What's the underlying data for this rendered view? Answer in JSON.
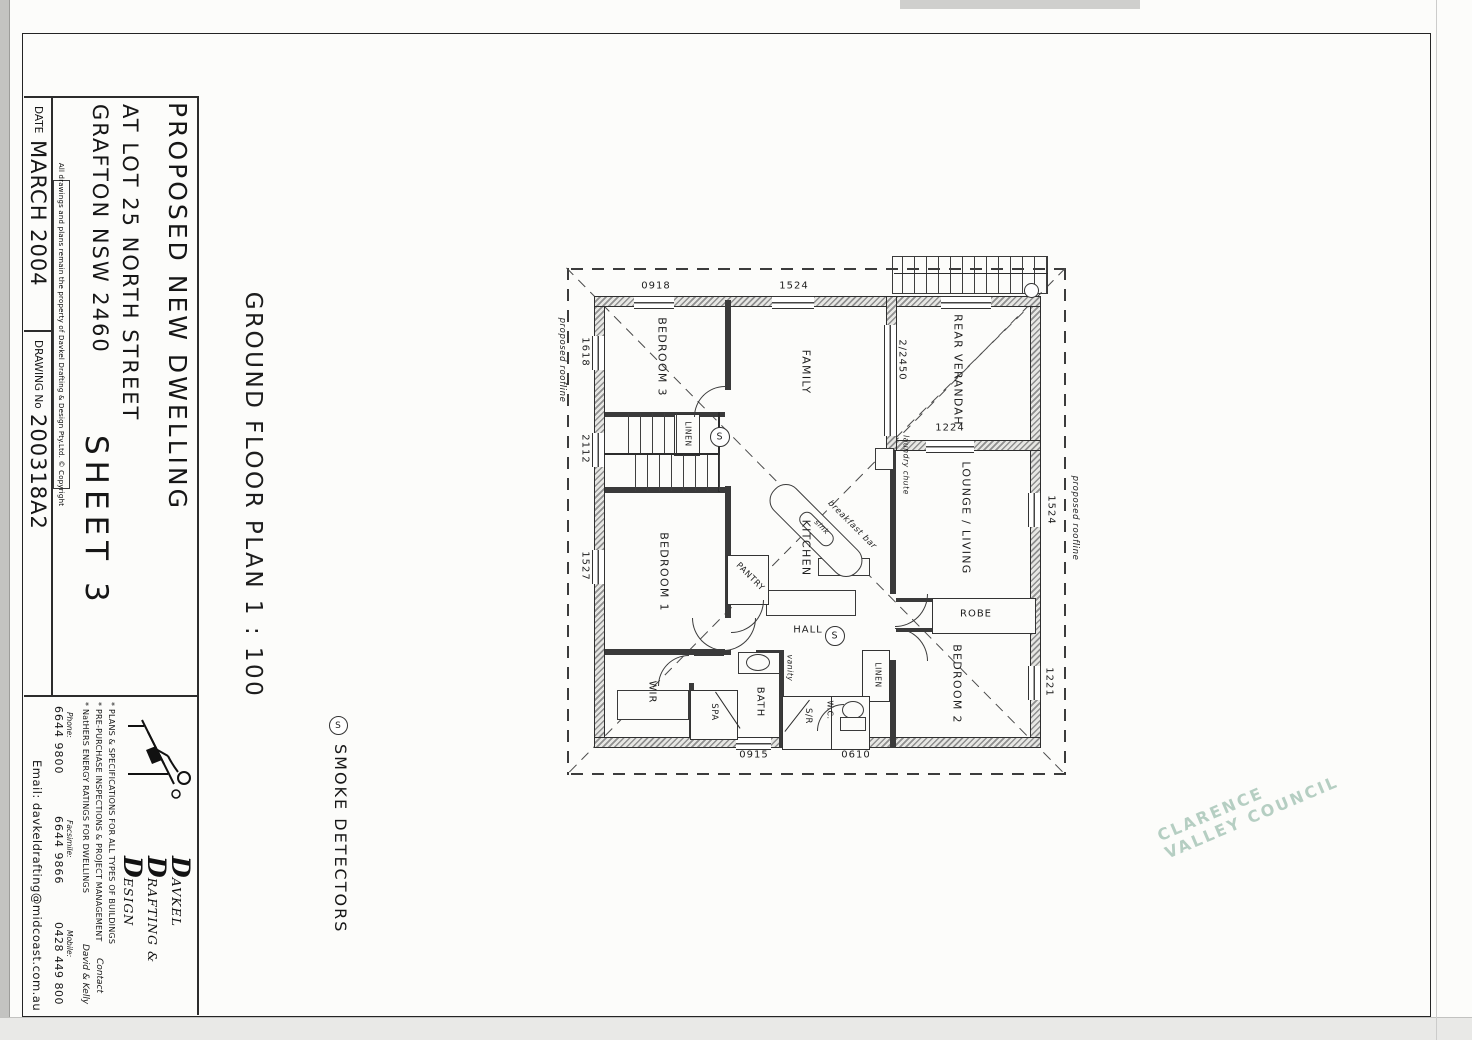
{
  "sheet": {
    "watermark": "CLARENCE VALLEY COUNCIL",
    "caption": "GROUND FLOOR PLAN  1 : 100",
    "legend_symbol": "S",
    "legend_label": "SMOKE DETECTORS"
  },
  "title_block": {
    "project_title": "PROPOSED NEW DWELLING",
    "address_line1": "AT LOT 25 NORTH STREET",
    "address_line2": "GRAFTON NSW 2460",
    "sheet_label": "SHEET 3",
    "date_label": "DATE",
    "date_value": "MARCH 2004",
    "drawing_no_label": "DRAWING No",
    "drawing_no_value": "200318A2",
    "copyright": "All drawings and plans remain the property of Davkel Drafting & Design Pty.Ltd. © Copyright"
  },
  "logo": {
    "initial": "D",
    "name_line1": "AVKEL",
    "name_line2": "RAFTING &",
    "name_line3": "ESIGN",
    "bullets": [
      "* PLANS & SPECIFICATIONS FOR ALL TYPES OF BUILDINGS",
      "* PRE-PURCHASE INSPECTIONS & PROJECT MANAGEMENT",
      "* NatHERS ENERGY RATINGS FOR DWELLINGS"
    ],
    "phone_label": "Phone:",
    "phone": "6644 9800",
    "fax_label": "Facsimile:",
    "fax": "6644 9866",
    "mobile_label": "Mobile:",
    "mobile": "0428 449 800",
    "contact_label": "Contact",
    "contact_names": "David & Kelly",
    "email": "Email: davkeldrafting@midcoast.com.au"
  },
  "plan": {
    "rooms": [
      "REAR VERANDAH",
      "LOUNGE / LIVING",
      "BEDROOM 2",
      "ROBE",
      "FAMILY",
      "BEDROOM 3",
      "BEDROOM 1",
      "KITCHEN",
      "HALL",
      "WIR",
      "BATH",
      "SPA",
      "S/R",
      "W.C.",
      "LINEN",
      "LINEN",
      "PANTRY"
    ],
    "dims": [
      "0918",
      "1524",
      "1524",
      "1221",
      "1618",
      "2112",
      "1527",
      "0915",
      "0610",
      "1224",
      "2/2450"
    ],
    "labels": [
      "sink",
      "breakfast bar",
      "laundry chute",
      "vanity",
      "proposed roofline",
      "proposed roofline"
    ],
    "sd": "S"
  }
}
